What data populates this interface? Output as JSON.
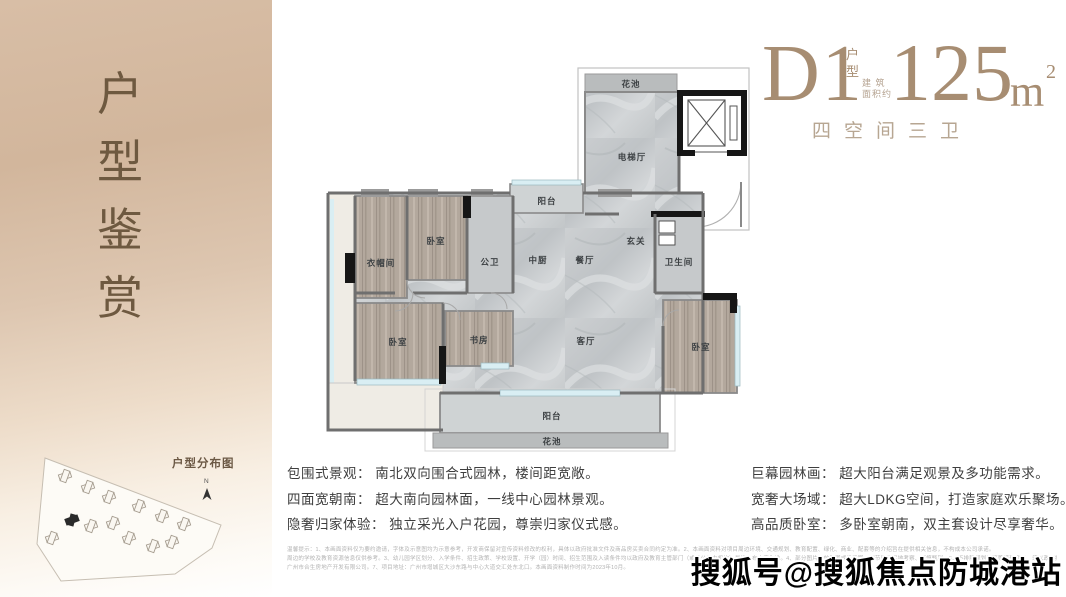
{
  "sidebar": {
    "title_chars": [
      "户",
      "型",
      "鉴",
      "赏"
    ],
    "sitemap_label": "户型分布图",
    "compass": "N",
    "title_color": "#6e5940"
  },
  "header": {
    "plan_code": "D1",
    "plan_code_label_1": "户",
    "plan_code_label_2": "型",
    "area_prefix": "建 筑\n面积约",
    "area_value": "125",
    "area_unit": "m",
    "area_sup": "2",
    "subtitle": "四空间三卫",
    "accent_color": "#a78d72"
  },
  "floorplan": {
    "rooms": [
      "花池",
      "电梯厅",
      "阳台",
      "衣帽间",
      "卧室",
      "公卫",
      "中厨",
      "餐厅",
      "玄关",
      "卫生间",
      "卧室",
      "书房",
      "客厅",
      "卧室",
      "阳台",
      "花池"
    ]
  },
  "features": {
    "left": [
      "包围式景观： 南北双向围合式园林，楼间距宽敞。",
      "四面宽朝南： 超大南向园林面，一线中心园林景观。",
      "隐奢归家体验： 独立采光入户花园，尊崇归家仪式感。"
    ],
    "right": [
      "巨幕园林画： 超大阳台满足观景及多功能需求。",
      "宽奢大场域： 超大LDKG空间，打造家庭欢乐聚场。",
      "高品质卧室： 多卧室朝南，双主套设计尽享奢华。"
    ]
  },
  "disclaimer": {
    "lines": [
      "温馨提示：1、本画面资料仅为要约邀请，字体及示意图均为示意参考，开发商保留对宣传资料修改的权利，具体以政府批准文件及商品房买卖合同约定为准。2、本画面资料对项目周边环境、交通规划、教育配置、绿化、商业、配套等的介绍旨在提供相关信息，不构成本公司承诺。",
      "周边的学校及教育资源信息仅供参考。3、幼儿园学区划分、入学条件、招生政策、学校设置、开学（园）时间、招生范围及入读条件均以政府及教育主管部门（或具公信力机构）最终公布内容为准。4、部分图片为效果图或示意图，细节建议实地考察、谨慎甄别。5、不排除规划调整等情形变更，须以政府批复为准。",
      "广州市合生房地产开发有限公司。7、项目地址：广州市增城区大沙东路与中心大道交汇处东北口。本画面资料制作时间为2023年10月。"
    ]
  },
  "watermark": "搜狐号@搜狐焦点防城港站"
}
